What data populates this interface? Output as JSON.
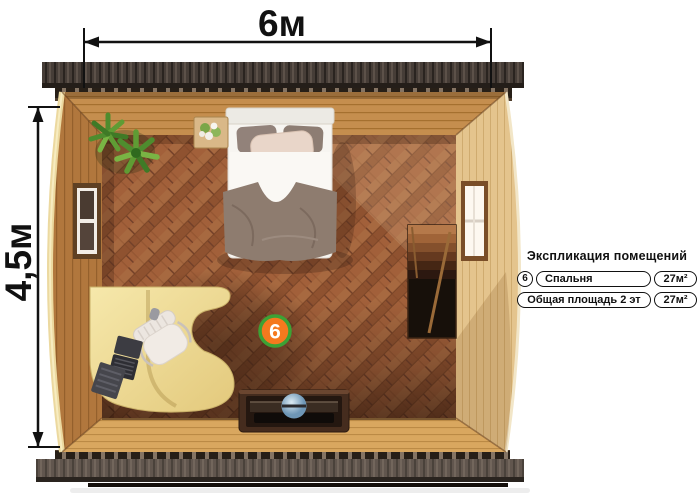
{
  "plan": {
    "dimensions": {
      "width_label": "6м",
      "height_label": "4,5м"
    },
    "room_marker": {
      "number": "6"
    },
    "colors": {
      "marker_fill": "#f5791e",
      "marker_border": "#3ca235",
      "floor_wood": "#9d5c34",
      "wall_left": "#b1773d",
      "wall_right": "#e4c48d",
      "roof": "#463d37",
      "desk": "#eeda92",
      "dimension_line": "#111111"
    },
    "furniture": [
      "bed",
      "nightstand-flowers",
      "potted-plant",
      "desk",
      "office-chair",
      "laptop",
      "tv-console",
      "staircase",
      "window-left",
      "window-right"
    ]
  },
  "legend": {
    "title": "Экспликация помещений",
    "rows": [
      {
        "marker": "6",
        "name": "Спальня",
        "area": "27м²"
      },
      {
        "name": "Общая площадь 2 эт",
        "area": "27м²"
      }
    ]
  }
}
